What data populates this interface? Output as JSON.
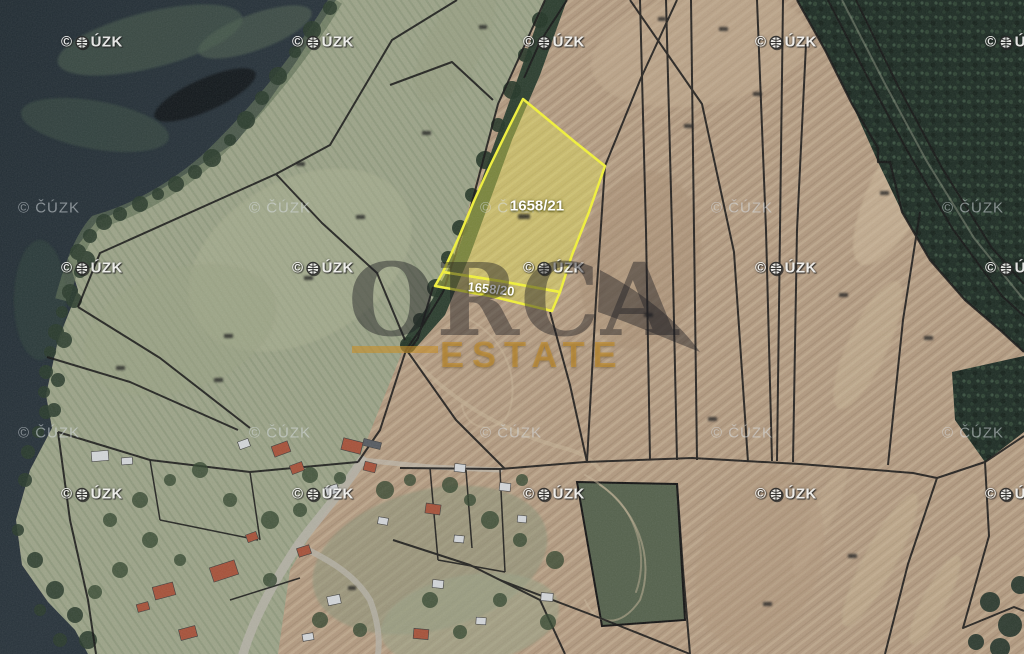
{
  "meta": {
    "type": "cadastral-aerial-map"
  },
  "highlight": {
    "primary_label": "1658/21",
    "secondary_label": "1658/20",
    "outline_color": "#f2f23a",
    "fill_color": "#e8e850"
  },
  "watermarks": {
    "provider_bold": {
      "copyright": "©",
      "suffix": "ÚZK",
      "icon": "globe-icon",
      "rows": [
        42,
        268,
        494
      ],
      "cols": [
        61,
        292,
        523,
        755,
        985
      ]
    },
    "provider_plain": {
      "text": "© ČÚZK",
      "rows": [
        208,
        433
      ],
      "cols": [
        18,
        249,
        480,
        711,
        942
      ]
    }
  },
  "brand": {
    "name": "ORCA",
    "subtitle": "ESTATE",
    "accent_color": "rgba(199,143,43,0.62)",
    "name_color": "rgba(30,30,36,0.45)"
  },
  "colors": {
    "water": "#27323a",
    "field_green": "#9da489",
    "field_brown": "#b29a80",
    "forest": "#1e2d25",
    "parcel_line": "#161616"
  }
}
